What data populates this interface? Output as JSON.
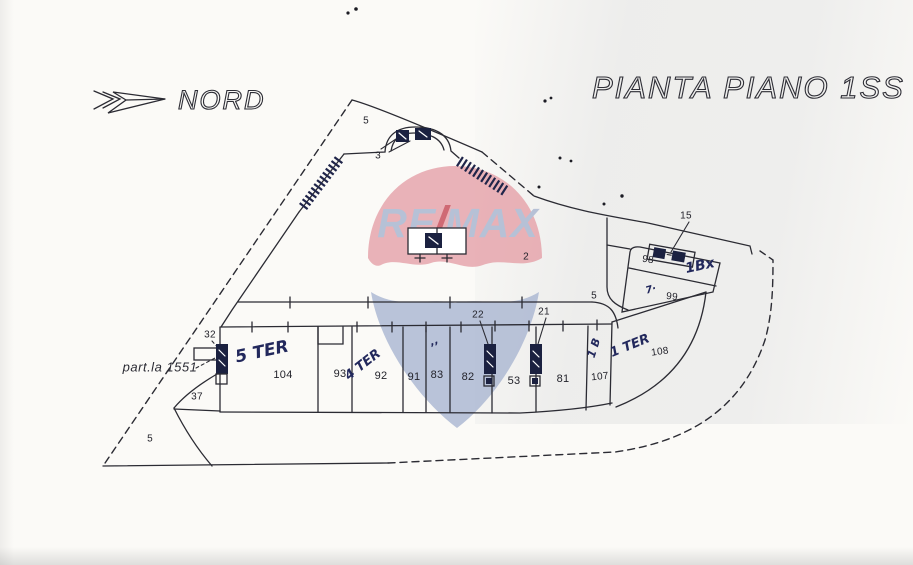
{
  "title": "PIANTA PIANO 1SS",
  "compass": {
    "label": "NORD"
  },
  "watermark": {
    "re": "RE",
    "slash": "/",
    "max": "MAX",
    "balloon_red": "#e5a0a7",
    "balloon_blue": "#a9b5d1",
    "text_blue": "#b6c1d6",
    "text_red": "#cf6a74"
  },
  "parcel": {
    "label": "part.la 1551"
  },
  "labels": {
    "zone_5_top": "5",
    "zone_3": "3",
    "zone_2": "2",
    "zone_5_corridor": "5",
    "zone_5_bottom": "5",
    "zone_37": "37",
    "zone_32": "32",
    "zone_22": "22",
    "zone_21": "21",
    "zone_15": "15",
    "room_98": "98",
    "room_99": "99",
    "room_104": "104",
    "room_93": "93",
    "room_92": "92",
    "room_91": "91",
    "room_83": "83",
    "room_82": "82",
    "room_53": "53",
    "room_81": "81",
    "room_107": "107",
    "room_108": "108"
  },
  "annotations": {
    "ann_5ter": "5 TER",
    "ann_4ter": "4 TER",
    "ann_1ter": "1 TER",
    "ann_1b": "1 B",
    "ann_1bx": "1Bx",
    "ann_check": "7·",
    "ann_marks": "’’"
  },
  "colors": {
    "ink": "#2b2b33",
    "hand_ink": "#22285c",
    "paper": "#fbfaf7"
  }
}
